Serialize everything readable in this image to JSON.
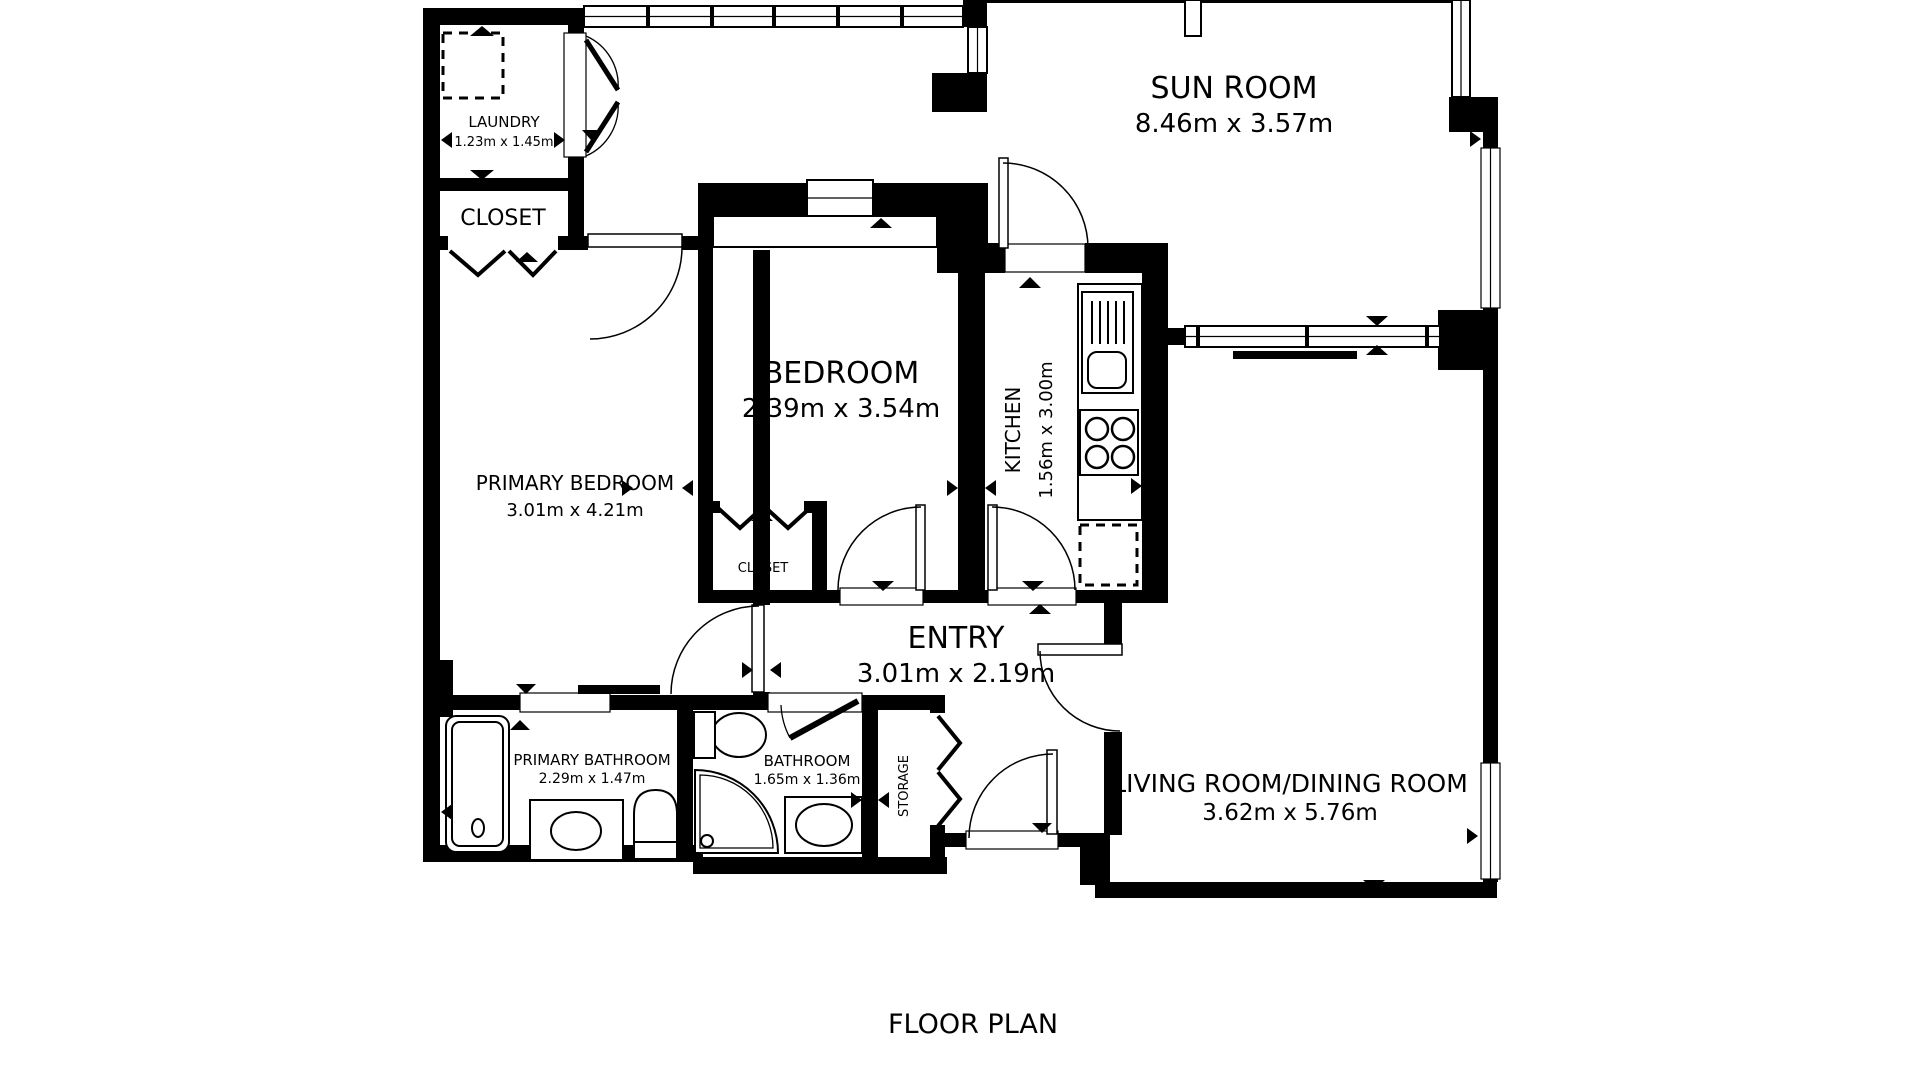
{
  "title": "FLOOR PLAN",
  "colors": {
    "wall": "#000000",
    "background": "#ffffff"
  },
  "rooms": {
    "sun_room": {
      "name": "SUN ROOM",
      "dimensions": "8.46m x 3.57m"
    },
    "laundry": {
      "name": "LAUNDRY",
      "dimensions": "1.23m x 1.45m"
    },
    "closet": {
      "name": "CLOSET"
    },
    "primary_bedroom": {
      "name": "PRIMARY BEDROOM",
      "dimensions": "3.01m x 4.21m"
    },
    "bedroom": {
      "name": "BEDROOM",
      "dimensions": "2.39m x 3.54m"
    },
    "bedroom_closet": {
      "name": "CLOSET"
    },
    "kitchen": {
      "name": "KITCHEN",
      "dimensions": "1.56m x 3.00m"
    },
    "entry": {
      "name": "ENTRY",
      "dimensions": "3.01m x 2.19m"
    },
    "primary_bathroom": {
      "name": "PRIMARY BATHROOM",
      "dimensions": "2.29m x 1.47m"
    },
    "bathroom": {
      "name": "BATHROOM",
      "dimensions": "1.65m x 1.36m"
    },
    "storage": {
      "name": "STORAGE"
    },
    "living_dining": {
      "name": "LIVING ROOM/DINING ROOM",
      "dimensions": "3.62m x 5.76m"
    }
  }
}
